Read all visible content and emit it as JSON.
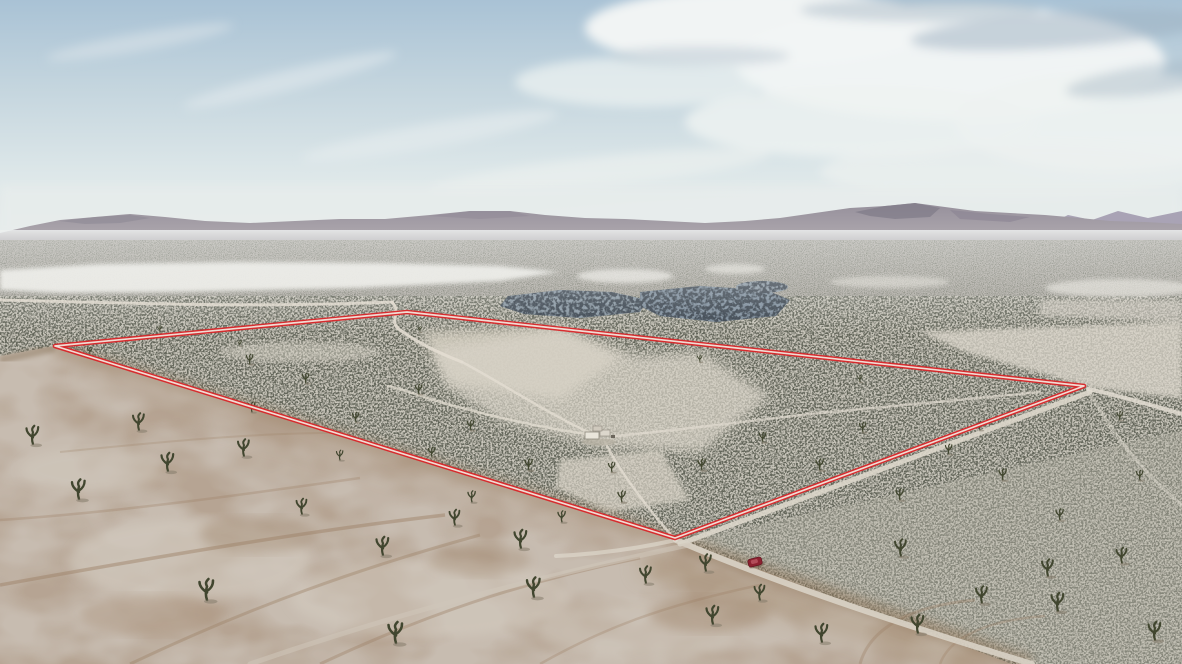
{
  "scene": {
    "type": "aerial-drone-photograph",
    "description": "Aerial drone photo of a high-desert valley: a large land parcel outlined in red on scrubland dotted with Joshua trees; tan dirt foreground crossed by tire tracks and dirt roads; a white dry lake bed, a blue-gray brush patch and mauve mountain ridges on the horizon under a pale blue sky with wispy white clouds; a small dark-red vehicle parked on the road at the parcel's lower corner.",
    "visible_text": "none"
  },
  "annotation": {
    "boundary_points": "55,346 407,312 1084,386 675,538",
    "boundary_color": "#d8262a",
    "boundary_gap_color": "#f4efe7"
  },
  "vehicle": {
    "name": "red-car",
    "fill": "#8c2230",
    "transform": "translate(755,562) rotate(-14)"
  },
  "palette": {
    "sky_top": "#a7c0d3",
    "sky_horizon": "#e9edec",
    "cloud_white": "#f4f7f6",
    "cloud_shadow": "#9db1c1",
    "mountain": "#9a94a0",
    "distant_peaks": "#9e96ac",
    "dry_lake": "#ecebe6",
    "scrub_base": "#c9c6bb",
    "scrub_speckle": "#666a5c",
    "blue_patch": "#8093a3",
    "dirt_tan": "#c7bcb0",
    "track_brown": "#9b7f63",
    "road_light": "#e3ddd2",
    "structure_gray": "#e9e5db"
  }
}
